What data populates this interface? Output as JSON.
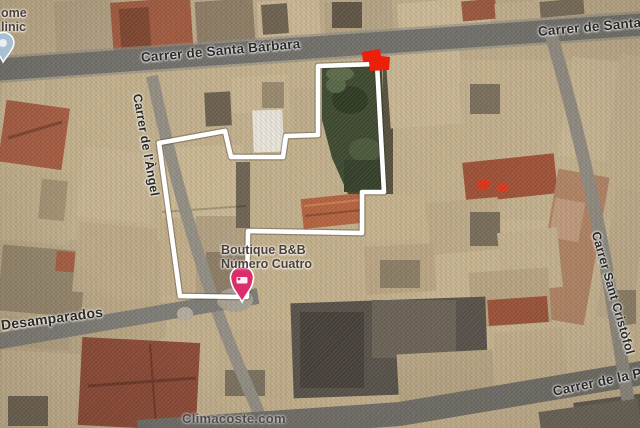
{
  "streets": {
    "santa_barbara": "Carrer de Santa Bárbara",
    "santa_barbara_right": "Carrer de Santa",
    "angel": "Carrer de l'Àngel",
    "desamparados": "Desamparados",
    "sant_cristofol": "Carrer Sant Cristòfol",
    "de_la_p": "Carrer de la P"
  },
  "pois": {
    "boutique_bb": {
      "line1": "Boutique B&B",
      "line2": "Número Cuatro",
      "marker_color": "#d92e6b"
    },
    "clinic": {
      "line1": "ome",
      "line2": "linic",
      "marker_color": "#a9bfd3"
    }
  },
  "property": {
    "outline_color": "#ffffff",
    "marker_color": "#ec1f0a"
  },
  "watermark": "Climacoste.com",
  "colors": {
    "terrain_tan": "#c3b18e",
    "road_major": "#6f6e69",
    "road_minor": "#938f85",
    "courtyard_green": "#3d4931",
    "roof_terracotta": "#a65c42"
  }
}
